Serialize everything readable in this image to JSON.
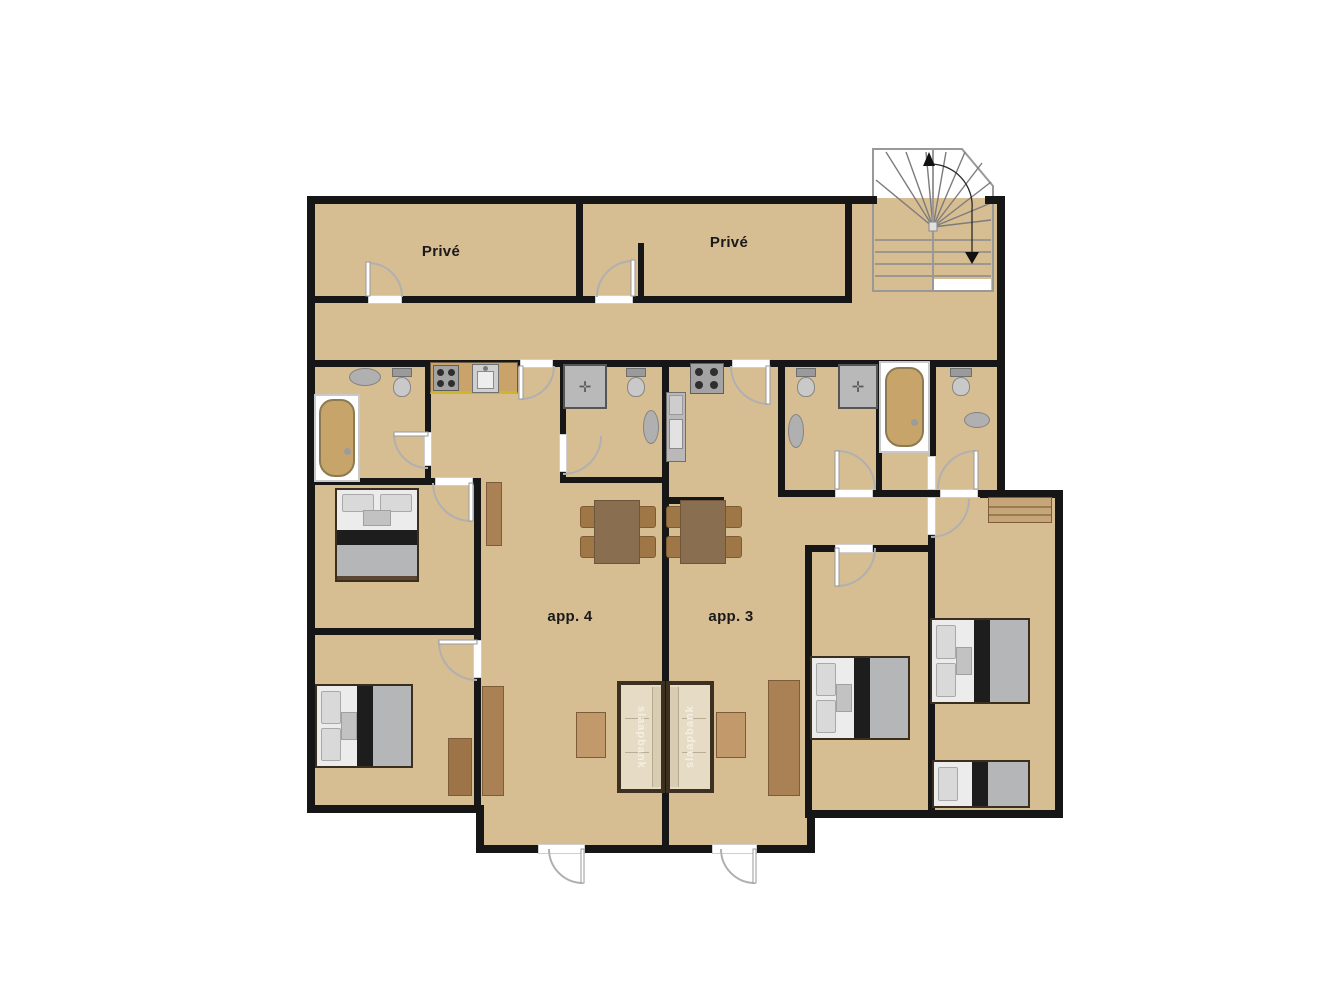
{
  "labels": {
    "room_top_left": "Privé",
    "room_top_right": "Privé",
    "apartment_left": "app. 4",
    "apartment_right": "app. 3",
    "sofa_left": "slaapbank",
    "sofa_right": "slaapbank"
  },
  "colors": {
    "floor": "#d7bd92",
    "wall": "#161616",
    "wood": "#aa8055",
    "couch_cushion": "#e6dcc6",
    "couch_frame": "#3c3020",
    "bed_blanket": "#b5b6b8",
    "bed_band": "#1d1d1d",
    "fixture": "#b0b0b0",
    "tub": "#c7a469",
    "door_arc": "#b0b0b0",
    "label_text": "#1a1a1a",
    "sofa_label_text": "#f5efe2",
    "counter_edge": "#cdb62a"
  }
}
